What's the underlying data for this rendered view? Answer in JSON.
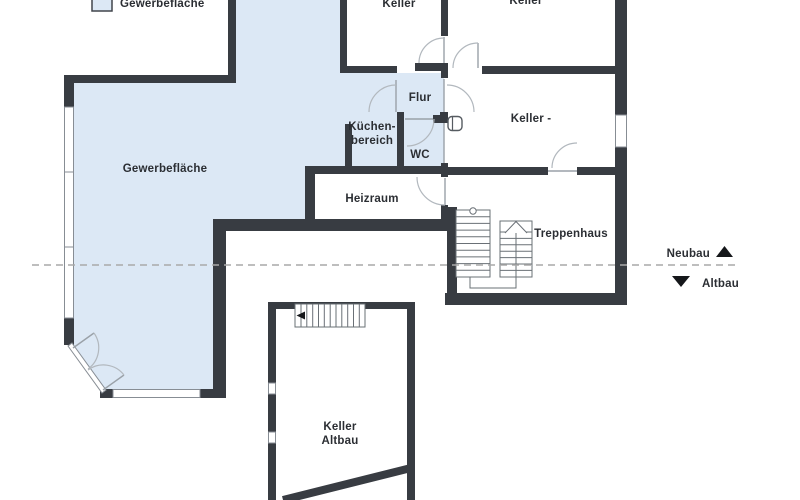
{
  "legend": {
    "label": "Gewerbefläche"
  },
  "rooms": {
    "gewerbeflaeche": "Gewerbefläche",
    "keller_top_left": "Keller",
    "keller_top_right": "Keller",
    "flur": "Flur",
    "kuechenbereich": [
      "Küchen-",
      "bereich"
    ],
    "wc": "WC",
    "keller_mitte": "Keller -",
    "heizraum": "Heizraum",
    "treppenhaus": "Treppenhaus",
    "keller_altbau": [
      "Keller",
      "Altbau"
    ]
  },
  "markers": {
    "neubau": "Neubau",
    "altbau": "Altbau"
  },
  "colors": {
    "floor": "#dce8f5",
    "wall": "#383c42",
    "line": "#b2b8be",
    "thin": "#9aa1a8",
    "stair": "#6a7076",
    "dash": "#a9a9a9",
    "text": "#2b2e33"
  }
}
